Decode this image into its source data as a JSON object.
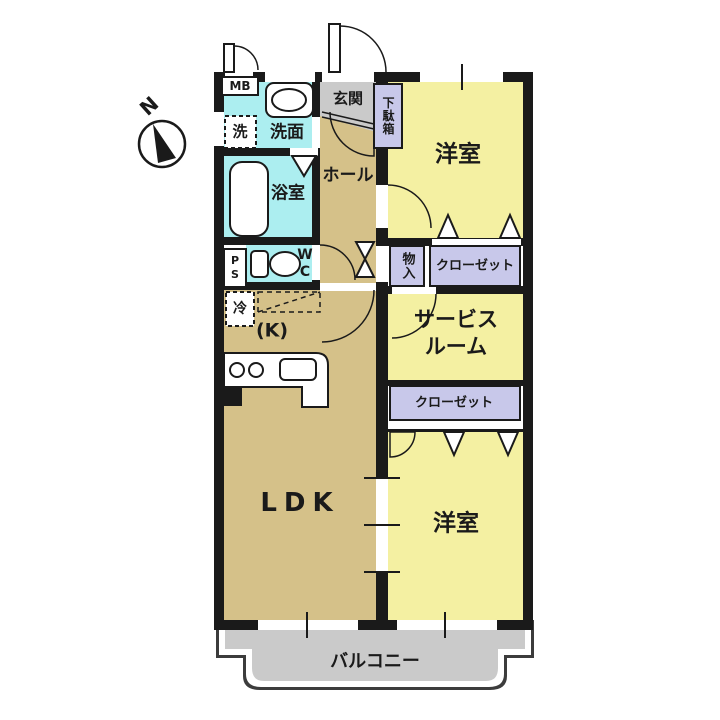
{
  "title": "2SLDK apartment floor plan",
  "palette": {
    "room_yellow": "#f4f0a2",
    "floor_tan": "#d5c189",
    "wet_area_cyan": "#aceef0",
    "closet_lavender": "#c8c8ea",
    "concrete_gray": "#cacaca",
    "wall_black": "#1a1a1a",
    "background": "#ffffff"
  },
  "compass": {
    "north_label": "N"
  },
  "rooms": {
    "meter_box": "MB",
    "washer": "洗",
    "washroom": "洗面",
    "entrance": "玄関",
    "shoe_box": "下駄箱",
    "bath": "浴室",
    "hall": "ホール",
    "bedroom_top": "洋室",
    "storage": "物入",
    "closet_top": "クローゼット",
    "pipe_space": "PS",
    "toilet": "WC",
    "refrigerator": "冷",
    "kitchen": "(K)",
    "service_room_line1": "サービス",
    "service_room_line2": "ルーム",
    "closet_bottom": "クローゼット",
    "ldk": "LDK",
    "bedroom_bottom": "洋室",
    "balcony": "バルコニー"
  }
}
